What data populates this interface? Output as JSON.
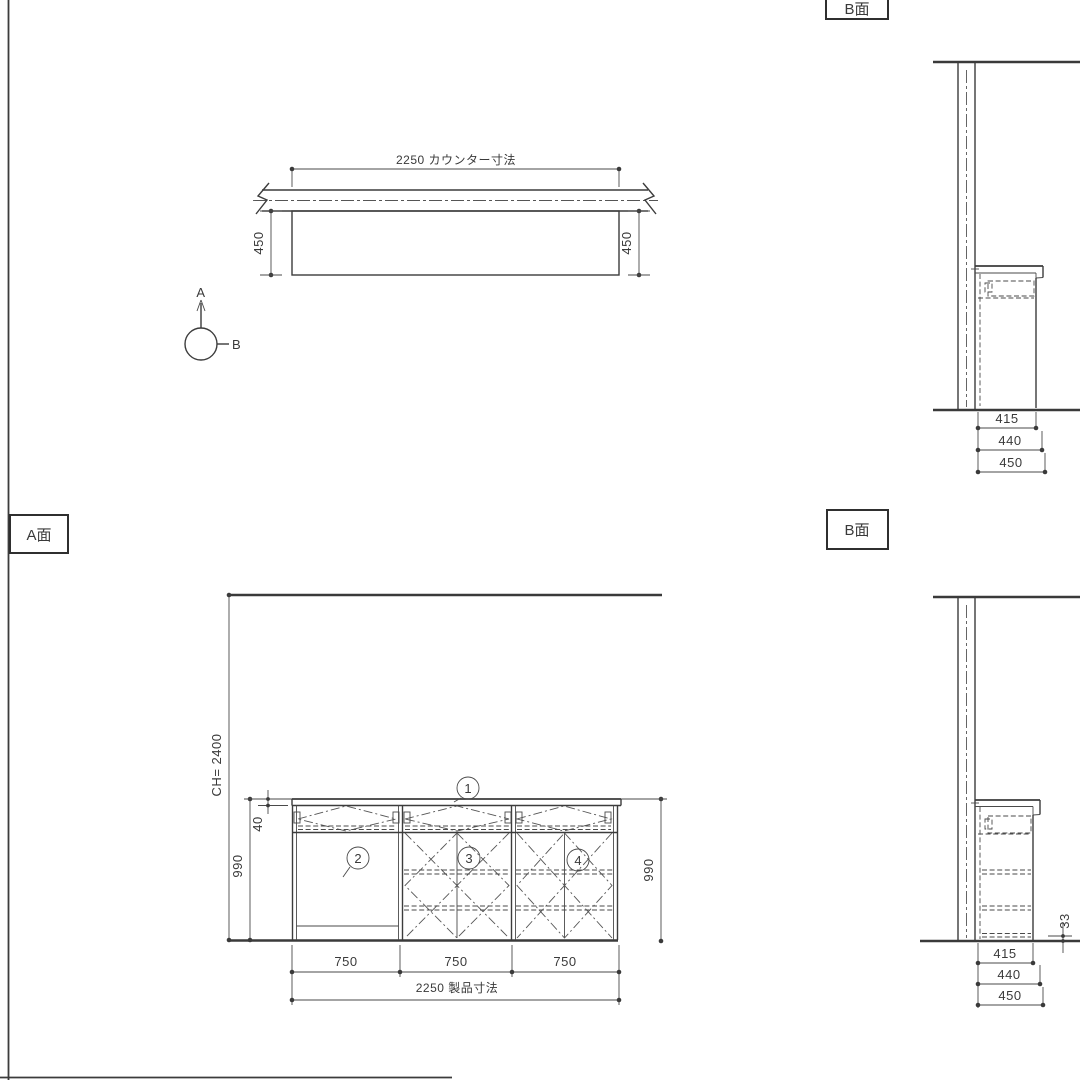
{
  "labels": {
    "b_top": "B面",
    "a_elev": "A面",
    "b_bottom": "B面"
  },
  "plan": {
    "counter_dim": "2250 カウンター寸法",
    "depth_left": "450",
    "depth_right": "450"
  },
  "marker": {
    "up": "A",
    "right": "B"
  },
  "b_top": {
    "d415": "415",
    "d440": "440",
    "d450": "450"
  },
  "a_elev": {
    "ceiling_height": "CH= 2400",
    "height_left": "990",
    "height_right": "990",
    "rail": "40",
    "bay1": "750",
    "bay2": "750",
    "bay3": "750",
    "total": "2250 製品寸法",
    "callout1": "1",
    "callout2": "2",
    "callout3": "3",
    "callout4": "4"
  },
  "b_bottom": {
    "toe": "33",
    "d415": "415",
    "d440": "440",
    "d450": "450"
  }
}
